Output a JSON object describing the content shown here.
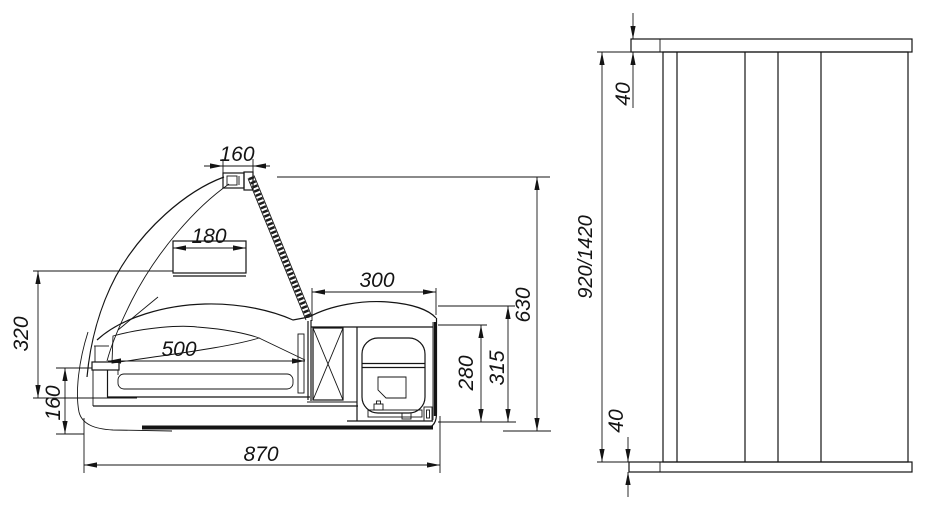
{
  "drawing": {
    "title": "refrigerated-display-case-dimension-drawing",
    "background": "#ffffff",
    "line_color": "#141414"
  },
  "dims": {
    "lamp_width": "160",
    "shelf_width": "180",
    "machine_top_width": "300",
    "deck_length": "500",
    "glass_height": "320",
    "base_height": "160",
    "overall_depth": "870",
    "overall_height_side": "630",
    "inner_height": "315",
    "machine_inner_height": "280",
    "front_total_height": "920/1420",
    "top_panel_thickness": "40",
    "bottom_panel_thickness": "40"
  }
}
